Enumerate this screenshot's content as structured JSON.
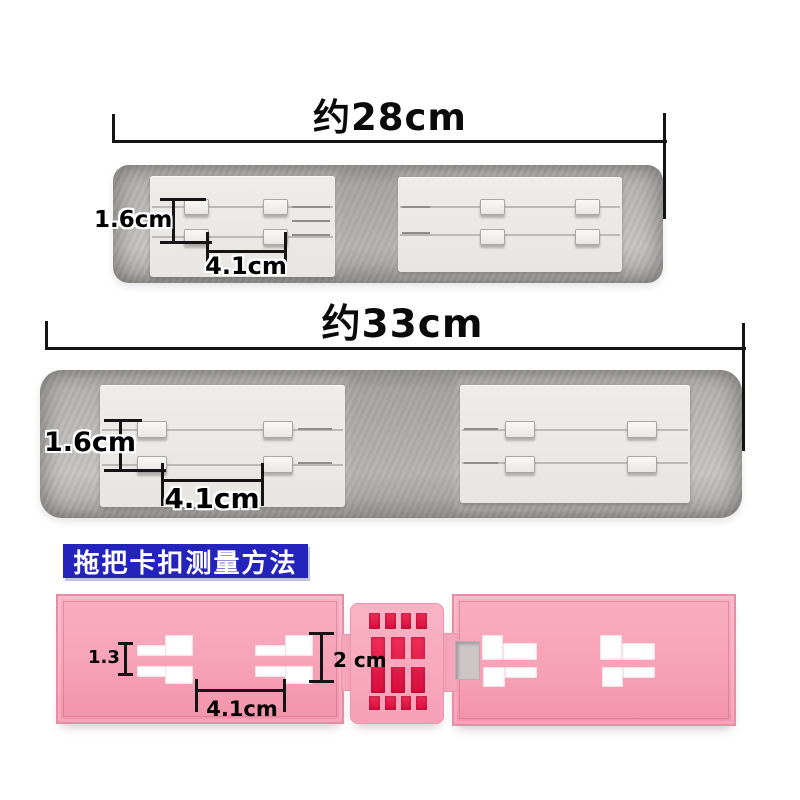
{
  "pad28": {
    "length_label": "约28cm",
    "height_label": "1.6cm",
    "gap_label": "4.1cm"
  },
  "pad33": {
    "length_label": "约33cm",
    "height_label": "1.6cm",
    "gap_label": "4.1cm"
  },
  "buckle": {
    "banner_label": "拖把卡扣测量方法",
    "slot_height_label": "1.3",
    "hinge_height_label": "2 cm",
    "slot_gap_label": "4.1cm"
  },
  "colors": {
    "dimension_line": "#141414",
    "pad_gray": "#b5b3b1",
    "plate_white": "#eae8e4",
    "banner_blue": "#2424bd",
    "panel_pink": "#f7a2b7",
    "hinge_red": "#d90e3e"
  }
}
